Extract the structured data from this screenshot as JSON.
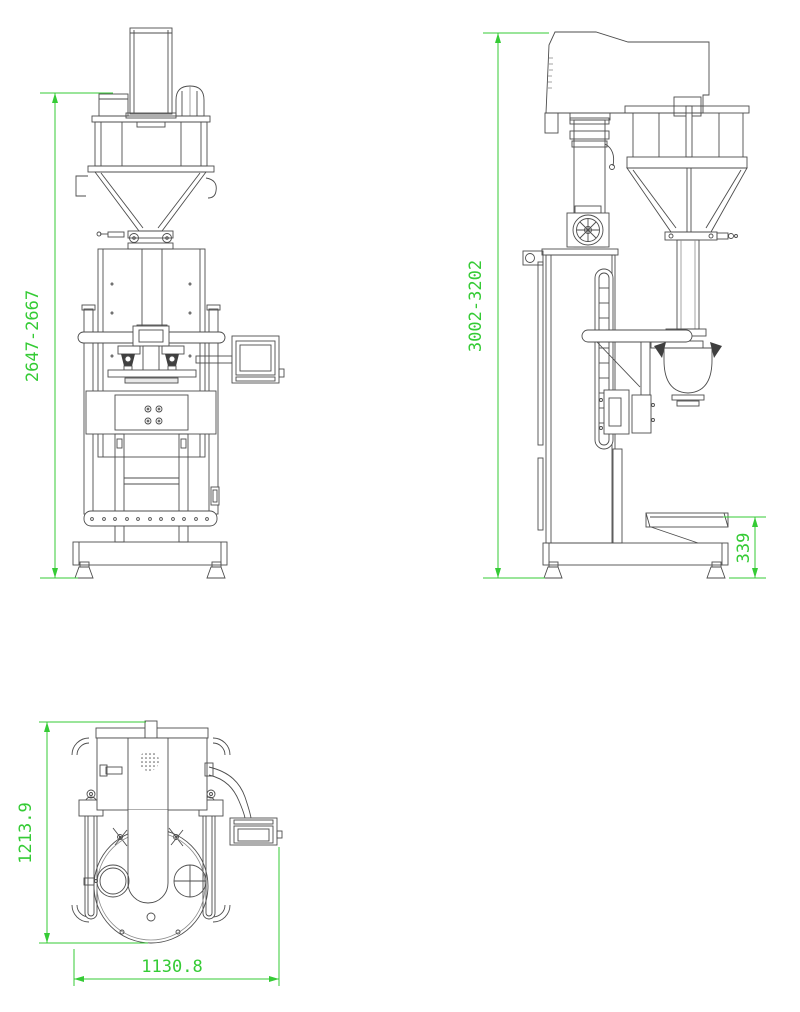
{
  "dimensions": {
    "front_height": "2647-2667",
    "side_height": "3002-3202",
    "side_conveyor_height": "339",
    "plan_depth": "1213.9",
    "plan_width": "1130.8"
  },
  "colors": {
    "dimension_green": "#35cb35",
    "drawing_line": "#4d4d4d"
  }
}
